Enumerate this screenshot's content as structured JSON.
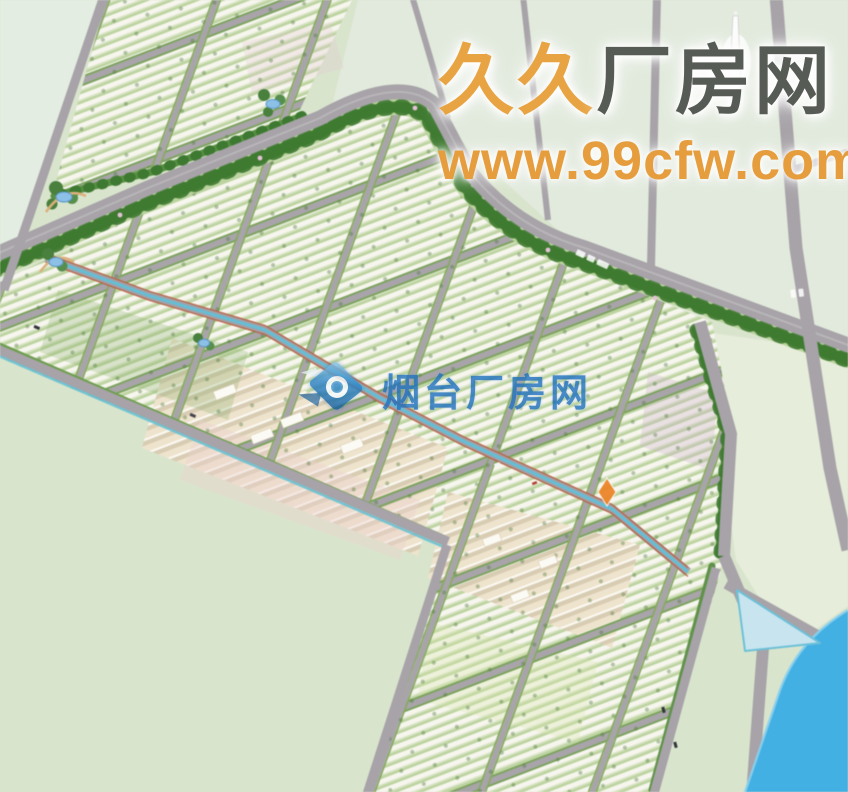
{
  "title": "industrial park master plan rendering",
  "watermark_corner": {
    "brand_highlight": "久久",
    "brand_rest": "厂房网",
    "url": "www.99cfw.com",
    "highlight_color": "#e8a443",
    "rest_color": "#575b55",
    "url_color": "#e59d3e"
  },
  "watermark_center": {
    "brand": "烟台厂房网",
    "color": "#2273bf",
    "logo": "compass-diamond-logo"
  },
  "map": {
    "type": "industrial-park-master-plan",
    "palette": {
      "land": "#d9e4cc",
      "land_light": "#e2eadc",
      "road": "#a7a3a8",
      "river": "#3eb1e7",
      "pond": "#c7e4f0",
      "canal": "#5fc0d8",
      "tree_belt": "#4b873a",
      "verge": "#b9d29a",
      "building_row_white": "#f7f6ee",
      "building_row_green": "#bcd49e",
      "cream_district": "#efe3cb",
      "accent_marker": "#f08524"
    }
  }
}
